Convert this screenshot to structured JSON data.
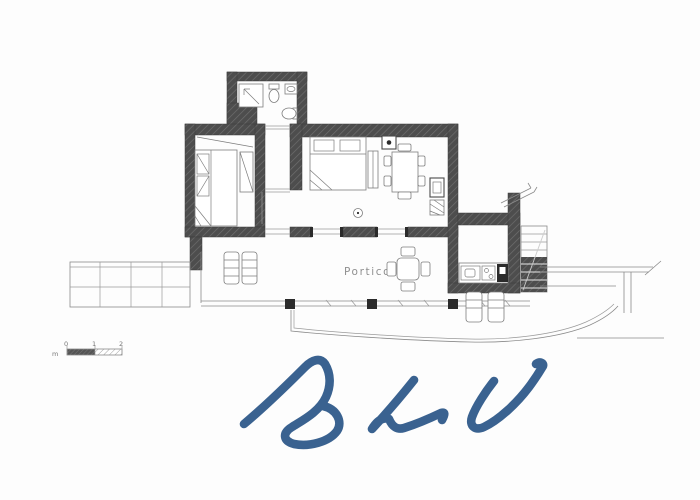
{
  "plan": {
    "portico_label": "Portico",
    "scale_bar": {
      "unit_label": "m",
      "tick_labels": [
        "0",
        "1",
        "2"
      ]
    }
  },
  "watermark": {
    "text": "BLU",
    "color": "#3a6290"
  },
  "colors": {
    "background": "#fdfdfd",
    "wall_fill": "#4d4d4d",
    "wall_hatch": "#6e6e6e",
    "thin_line": "#8a8a8a",
    "furniture_line": "#7d7d7d",
    "column_fill": "#2b2b2b",
    "label_text": "#8f8f8f"
  }
}
